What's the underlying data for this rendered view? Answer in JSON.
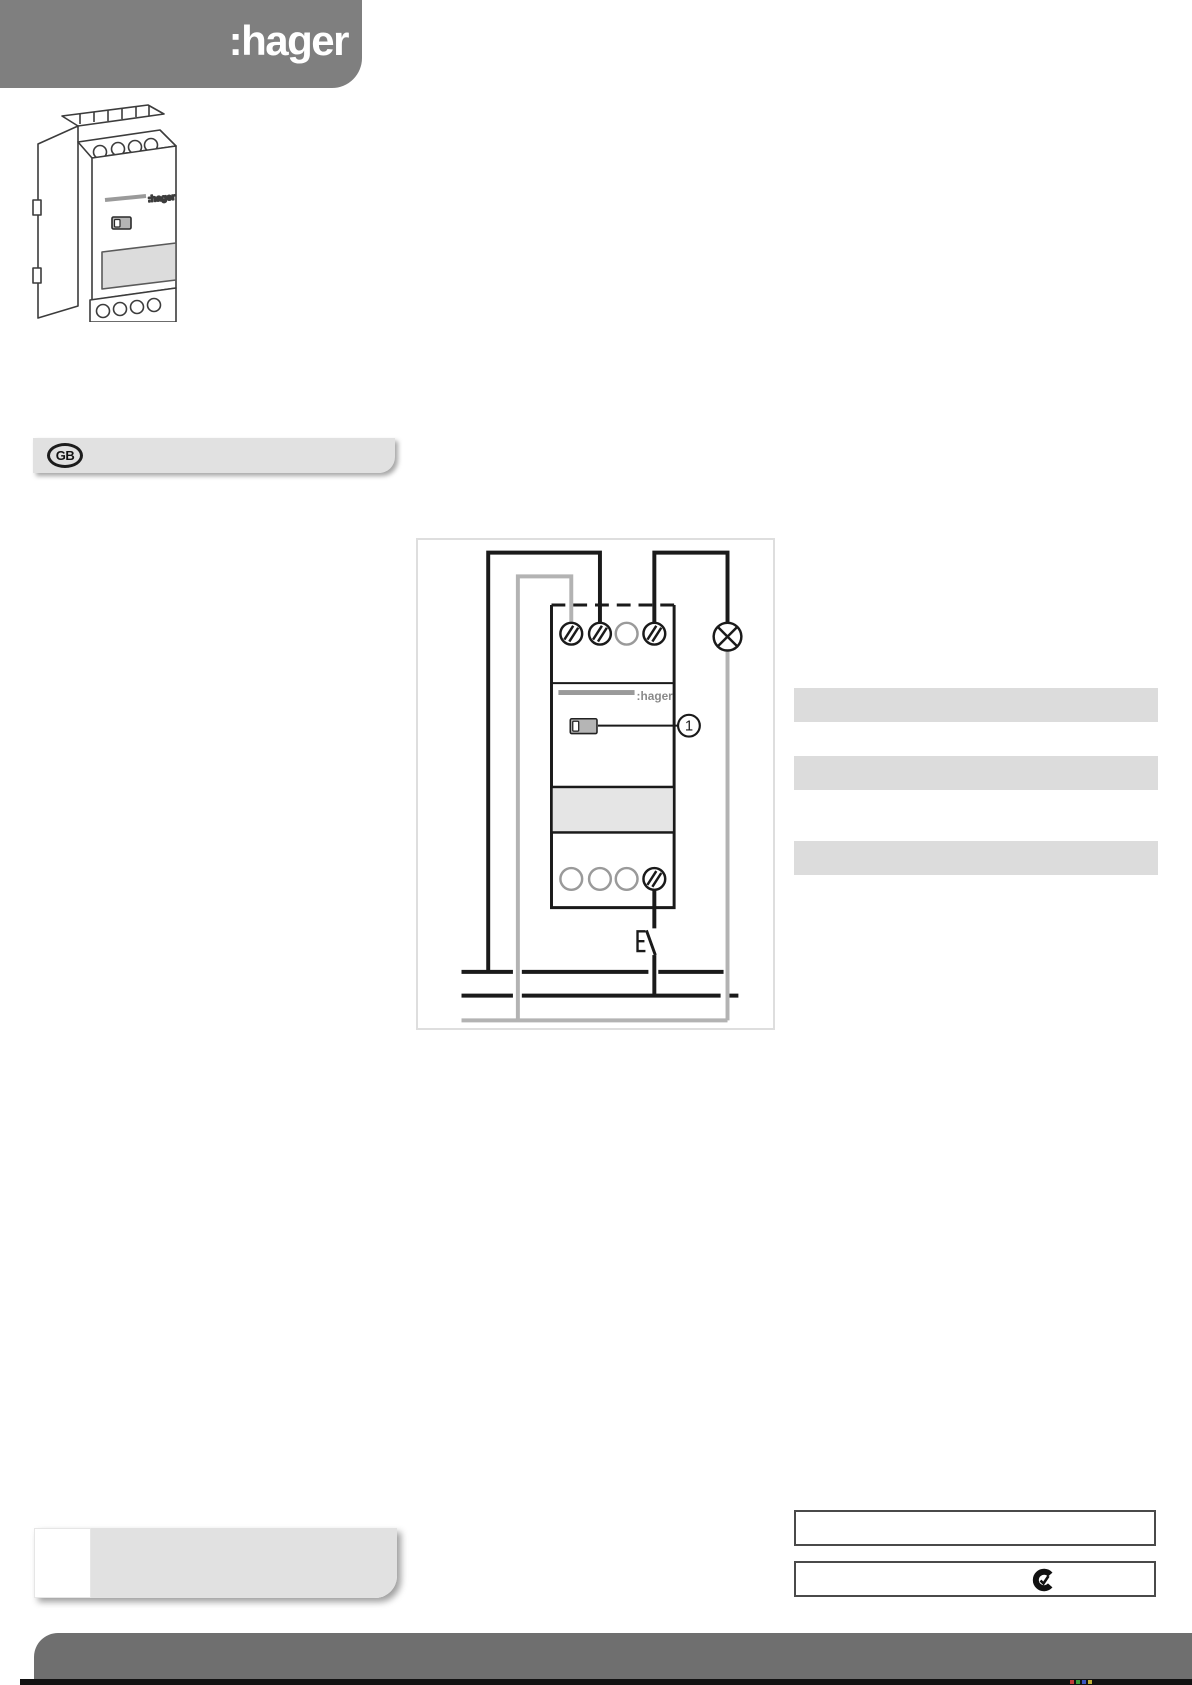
{
  "header": {
    "logo_text": ":hager",
    "bg_color": "#7f7f7f",
    "logo_color": "#ffffff"
  },
  "device_illustration": {
    "brand_text": ":hager",
    "description": "line drawing of 2-module DIN-rail timer with screw terminals top and bottom, slider switch and label recess"
  },
  "language_bar": {
    "label": "GB",
    "bar_color": "#e1e1e1"
  },
  "wiring_diagram": {
    "brand_text": ":hager",
    "callout_label": "1",
    "top_terminals": [
      "hatched",
      "hatched",
      "plain",
      "hatched"
    ],
    "bottom_terminals": [
      "plain",
      "plain",
      "plain",
      "hatched"
    ],
    "symbols": [
      "lamp",
      "push-button",
      "slider-switch"
    ],
    "colors": {
      "wire_black": "#1a1a1a",
      "wire_gray": "#b3b3b3",
      "frame_border": "#dedede",
      "label_band": "#e5e5e5"
    }
  },
  "right_placeholders": {
    "count": 3,
    "bar_color": "#dcdcdc"
  },
  "spec_boxes": {
    "box1_text": "",
    "box2_text": "",
    "box2_icon": "c-tick-mark"
  },
  "footnote_bar": {
    "bar_color": "#e1e1e1"
  },
  "footer": {
    "bar_color": "#6f6f6f"
  }
}
